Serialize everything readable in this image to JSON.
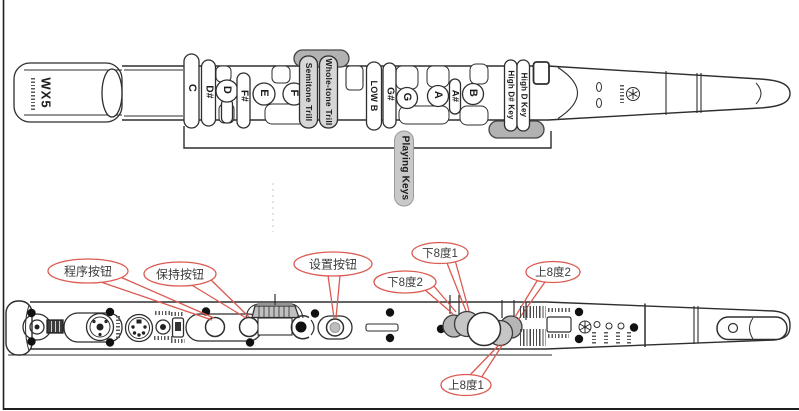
{
  "top_view": {
    "brand": "WX5",
    "keys": {
      "c": "C",
      "d_sharp": "D#",
      "d": "D",
      "f_sharp": "F#",
      "e": "E",
      "f": "F",
      "semitone_trill": "Semitone Trill",
      "whole_tone_trill": "Whole-tone Trill",
      "low_b": "LOW B",
      "g_sharp": "G#",
      "g": "G",
      "a": "A",
      "a_sharp": "A#",
      "b": "B",
      "high_d_sharp": "High D# Key",
      "high_d": "High D Key"
    },
    "group_label": "Playing Keys"
  },
  "bottom_view": {
    "callouts": {
      "program": "程序按钮",
      "hold": "保持按钮",
      "setup": "设置按钮",
      "octave_down_1": "下8度1",
      "octave_down_2": "下8度2",
      "octave_up_1": "上8度1",
      "octave_up_2": "上8度2"
    }
  },
  "colors": {
    "callout_red": "#db5a52",
    "line": "#2e2e2e",
    "gray_fill": "#b5b5b5",
    "light_gray_fill": "#d6d6d6",
    "pill_gray": "#c9c9c9"
  }
}
